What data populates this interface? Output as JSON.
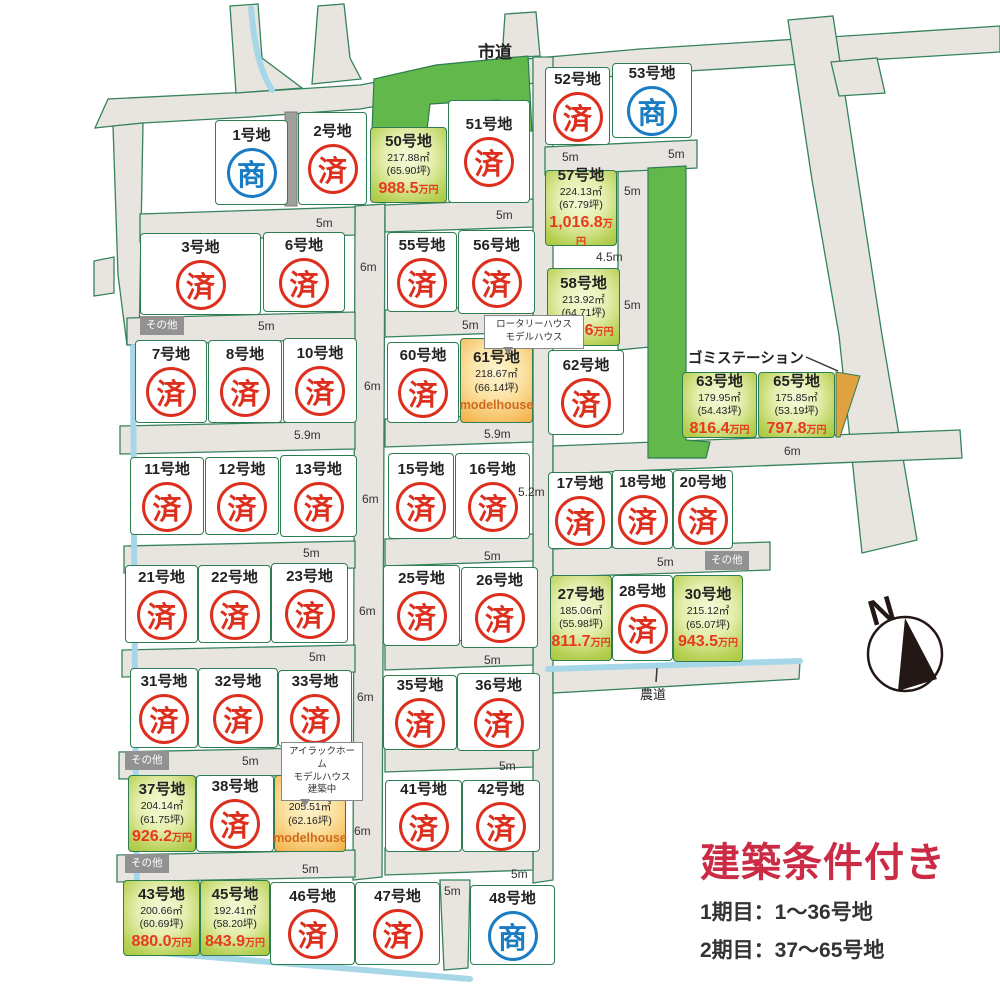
{
  "labels": {
    "city_road": "市道",
    "farm_road": "農道",
    "garbage_station": "ゴミステーション",
    "north": "N",
    "modelhouse": "modelhouse",
    "other_badges": [
      {
        "text": "その他",
        "x": 140,
        "y": 316
      },
      {
        "text": "その他",
        "x": 705,
        "y": 551
      },
      {
        "text": "その他",
        "x": 125,
        "y": 751
      },
      {
        "text": "その他",
        "x": 125,
        "y": 854
      }
    ]
  },
  "callouts": [
    {
      "lines": [
        "ロータリーハウス",
        "モデルハウス"
      ],
      "x": 484,
      "y": 315,
      "w": 90
    },
    {
      "lines": [
        "アイラックホーム",
        "モデルハウス",
        "建築中"
      ],
      "x": 281,
      "y": 742,
      "w": 72
    }
  ],
  "legend": {
    "title": "建築条件付き",
    "phase1": "1期目：1〜36号地",
    "phase2": "2期目：37〜65号地"
  },
  "stamps": {
    "sold": "済",
    "negotiating": "商"
  },
  "price_unit": "万円",
  "colors": {
    "road_fill": "#e8e5e0",
    "road_stroke": "#35825c",
    "dark_green": "#62b84a",
    "stream_blue": "#a6d7e8",
    "sold_red": "#dd2f1e",
    "negotiating_blue": "#1a7dc4",
    "price_red": "#e8391f",
    "available_green": "#a8c83f",
    "model_orange": "#f3ae42",
    "title_red": "#cb2b45"
  },
  "lots": [
    {
      "name": "1号地",
      "status": "negotiating",
      "x": 215,
      "y": 120,
      "w": 73,
      "h": 85
    },
    {
      "name": "2号地",
      "status": "sold",
      "x": 298,
      "y": 112,
      "w": 69,
      "h": 93
    },
    {
      "name": "50号地",
      "status": "available",
      "area": "217.88㎡",
      "tsubo": "(65.90坪)",
      "price": "988.5",
      "x": 370,
      "y": 127,
      "w": 77,
      "h": 76
    },
    {
      "name": "51号地",
      "status": "sold",
      "x": 448,
      "y": 100,
      "w": 82,
      "h": 103
    },
    {
      "name": "52号地",
      "status": "sold",
      "x": 545,
      "y": 67,
      "w": 65,
      "h": 78
    },
    {
      "name": "53号地",
      "status": "negotiating",
      "x": 612,
      "y": 63,
      "w": 80,
      "h": 75
    },
    {
      "name": "3号地",
      "status": "sold",
      "x": 140,
      "y": 233,
      "w": 121,
      "h": 82
    },
    {
      "name": "6号地",
      "status": "sold",
      "x": 263,
      "y": 232,
      "w": 82,
      "h": 80
    },
    {
      "name": "55号地",
      "status": "sold",
      "x": 387,
      "y": 232,
      "w": 70,
      "h": 80
    },
    {
      "name": "56号地",
      "status": "sold",
      "x": 458,
      "y": 230,
      "w": 77,
      "h": 84
    },
    {
      "name": "57号地",
      "status": "available",
      "area": "224.13㎡",
      "tsubo": "(67.79坪)",
      "price": "1,016.8",
      "x": 545,
      "y": 170,
      "w": 72,
      "h": 76
    },
    {
      "name": "58号地",
      "status": "available",
      "area": "213.92㎡",
      "tsubo": "(64.71坪)",
      "price": "970.6",
      "x": 547,
      "y": 268,
      "w": 73,
      "h": 78
    },
    {
      "name": "7号地",
      "status": "sold",
      "x": 135,
      "y": 340,
      "w": 72,
      "h": 83
    },
    {
      "name": "8号地",
      "status": "sold",
      "x": 208,
      "y": 340,
      "w": 74,
      "h": 83
    },
    {
      "name": "10号地",
      "status": "sold",
      "x": 283,
      "y": 338,
      "w": 74,
      "h": 85
    },
    {
      "name": "60号地",
      "status": "sold",
      "x": 387,
      "y": 342,
      "w": 72,
      "h": 81
    },
    {
      "name": "61号地",
      "status": "model",
      "area": "218.67㎡",
      "tsubo": "(66.14坪)",
      "x": 460,
      "y": 338,
      "w": 73,
      "h": 85
    },
    {
      "name": "62号地",
      "status": "sold",
      "x": 548,
      "y": 350,
      "w": 76,
      "h": 85
    },
    {
      "name": "63号地",
      "status": "available",
      "area": "179.95㎡",
      "tsubo": "(54.43坪)",
      "price": "816.4",
      "x": 682,
      "y": 372,
      "w": 75,
      "h": 66
    },
    {
      "name": "65号地",
      "status": "available",
      "area": "175.85㎡",
      "tsubo": "(53.19坪)",
      "price": "797.8",
      "x": 758,
      "y": 372,
      "w": 77,
      "h": 66
    },
    {
      "name": "11号地",
      "status": "sold",
      "x": 130,
      "y": 457,
      "w": 74,
      "h": 78
    },
    {
      "name": "12号地",
      "status": "sold",
      "x": 205,
      "y": 457,
      "w": 74,
      "h": 78
    },
    {
      "name": "13号地",
      "status": "sold",
      "x": 280,
      "y": 455,
      "w": 77,
      "h": 82
    },
    {
      "name": "15号地",
      "status": "sold",
      "x": 388,
      "y": 453,
      "w": 66,
      "h": 86
    },
    {
      "name": "16号地",
      "status": "sold",
      "x": 455,
      "y": 453,
      "w": 75,
      "h": 86
    },
    {
      "name": "17号地",
      "status": "sold",
      "x": 548,
      "y": 472,
      "w": 64,
      "h": 77
    },
    {
      "name": "18号地",
      "status": "sold",
      "x": 612,
      "y": 470,
      "w": 61,
      "h": 79
    },
    {
      "name": "20号地",
      "status": "sold",
      "x": 673,
      "y": 470,
      "w": 60,
      "h": 79
    },
    {
      "name": "21号地",
      "status": "sold",
      "x": 125,
      "y": 565,
      "w": 73,
      "h": 78
    },
    {
      "name": "22号地",
      "status": "sold",
      "x": 198,
      "y": 565,
      "w": 73,
      "h": 78
    },
    {
      "name": "23号地",
      "status": "sold",
      "x": 271,
      "y": 563,
      "w": 77,
      "h": 80
    },
    {
      "name": "25号地",
      "status": "sold",
      "x": 383,
      "y": 565,
      "w": 77,
      "h": 81
    },
    {
      "name": "26号地",
      "status": "sold",
      "x": 461,
      "y": 567,
      "w": 77,
      "h": 81
    },
    {
      "name": "27号地",
      "status": "available",
      "area": "185.06㎡",
      "tsubo": "(55.98坪)",
      "price": "811.7",
      "x": 550,
      "y": 575,
      "w": 62,
      "h": 86
    },
    {
      "name": "28号地",
      "status": "sold",
      "x": 612,
      "y": 575,
      "w": 61,
      "h": 86
    },
    {
      "name": "30号地",
      "status": "available",
      "area": "215.12㎡",
      "tsubo": "(65.07坪)",
      "price": "943.5",
      "x": 673,
      "y": 575,
      "w": 70,
      "h": 87
    },
    {
      "name": "31号地",
      "status": "sold",
      "x": 130,
      "y": 668,
      "w": 68,
      "h": 80
    },
    {
      "name": "32号地",
      "status": "sold",
      "x": 198,
      "y": 668,
      "w": 80,
      "h": 80
    },
    {
      "name": "33号地",
      "status": "sold",
      "x": 278,
      "y": 670,
      "w": 74,
      "h": 77
    },
    {
      "name": "35号地",
      "status": "sold",
      "x": 383,
      "y": 675,
      "w": 74,
      "h": 75
    },
    {
      "name": "36号地",
      "status": "sold",
      "x": 457,
      "y": 673,
      "w": 83,
      "h": 78
    },
    {
      "name": "37号地",
      "status": "available",
      "area": "204.14㎡",
      "tsubo": "(61.75坪)",
      "price": "926.2",
      "x": 128,
      "y": 775,
      "w": 68,
      "h": 77
    },
    {
      "name": "38号地",
      "status": "sold",
      "x": 196,
      "y": 775,
      "w": 78,
      "h": 77
    },
    {
      "name": "40号地",
      "status": "model",
      "area": "205.51㎡",
      "tsubo": "(62.16坪)",
      "x": 274,
      "y": 775,
      "w": 72,
      "h": 77
    },
    {
      "name": "41号地",
      "status": "sold",
      "x": 385,
      "y": 780,
      "w": 77,
      "h": 72
    },
    {
      "name": "42号地",
      "status": "sold",
      "x": 462,
      "y": 780,
      "w": 78,
      "h": 72
    },
    {
      "name": "43号地",
      "status": "available",
      "area": "200.66㎡",
      "tsubo": "(60.69坪)",
      "price": "880.0",
      "x": 123,
      "y": 880,
      "w": 77,
      "h": 76
    },
    {
      "name": "45号地",
      "status": "available",
      "area": "192.41㎡",
      "tsubo": "(58.20坪)",
      "price": "843.9",
      "x": 200,
      "y": 880,
      "w": 70,
      "h": 76
    },
    {
      "name": "46号地",
      "status": "sold",
      "x": 270,
      "y": 882,
      "w": 85,
      "h": 83
    },
    {
      "name": "47号地",
      "status": "sold",
      "x": 355,
      "y": 882,
      "w": 85,
      "h": 83
    },
    {
      "name": "48号地",
      "status": "negotiating",
      "x": 470,
      "y": 885,
      "w": 85,
      "h": 80
    }
  ],
  "road_labels": [
    {
      "text": "5m",
      "x": 316,
      "y": 216
    },
    {
      "text": "5m",
      "x": 496,
      "y": 208
    },
    {
      "text": "5m",
      "x": 562,
      "y": 150
    },
    {
      "text": "5m",
      "x": 668,
      "y": 147
    },
    {
      "text": "5m",
      "x": 624,
      "y": 184
    },
    {
      "text": "4.5m",
      "x": 596,
      "y": 250
    },
    {
      "text": "5m",
      "x": 624,
      "y": 298
    },
    {
      "text": "6m",
      "x": 360,
      "y": 260
    },
    {
      "text": "5m",
      "x": 258,
      "y": 319
    },
    {
      "text": "5m",
      "x": 462,
      "y": 318
    },
    {
      "text": "6m",
      "x": 364,
      "y": 379
    },
    {
      "text": "5.9m",
      "x": 294,
      "y": 428
    },
    {
      "text": "5.9m",
      "x": 484,
      "y": 427
    },
    {
      "text": "6m",
      "x": 784,
      "y": 444
    },
    {
      "text": "6m",
      "x": 362,
      "y": 492
    },
    {
      "text": "5.2m",
      "x": 518,
      "y": 485
    },
    {
      "text": "5m",
      "x": 303,
      "y": 546
    },
    {
      "text": "5m",
      "x": 484,
      "y": 549
    },
    {
      "text": "5m",
      "x": 657,
      "y": 555
    },
    {
      "text": "6m",
      "x": 359,
      "y": 604
    },
    {
      "text": "5m",
      "x": 309,
      "y": 650
    },
    {
      "text": "5m",
      "x": 484,
      "y": 653
    },
    {
      "text": "6m",
      "x": 357,
      "y": 690
    },
    {
      "text": "5m",
      "x": 242,
      "y": 754
    },
    {
      "text": "5m",
      "x": 499,
      "y": 759
    },
    {
      "text": "6m",
      "x": 354,
      "y": 824
    },
    {
      "text": "5m",
      "x": 302,
      "y": 862
    },
    {
      "text": "5m",
      "x": 511,
      "y": 867
    },
    {
      "text": "5m",
      "x": 444,
      "y": 884
    }
  ]
}
